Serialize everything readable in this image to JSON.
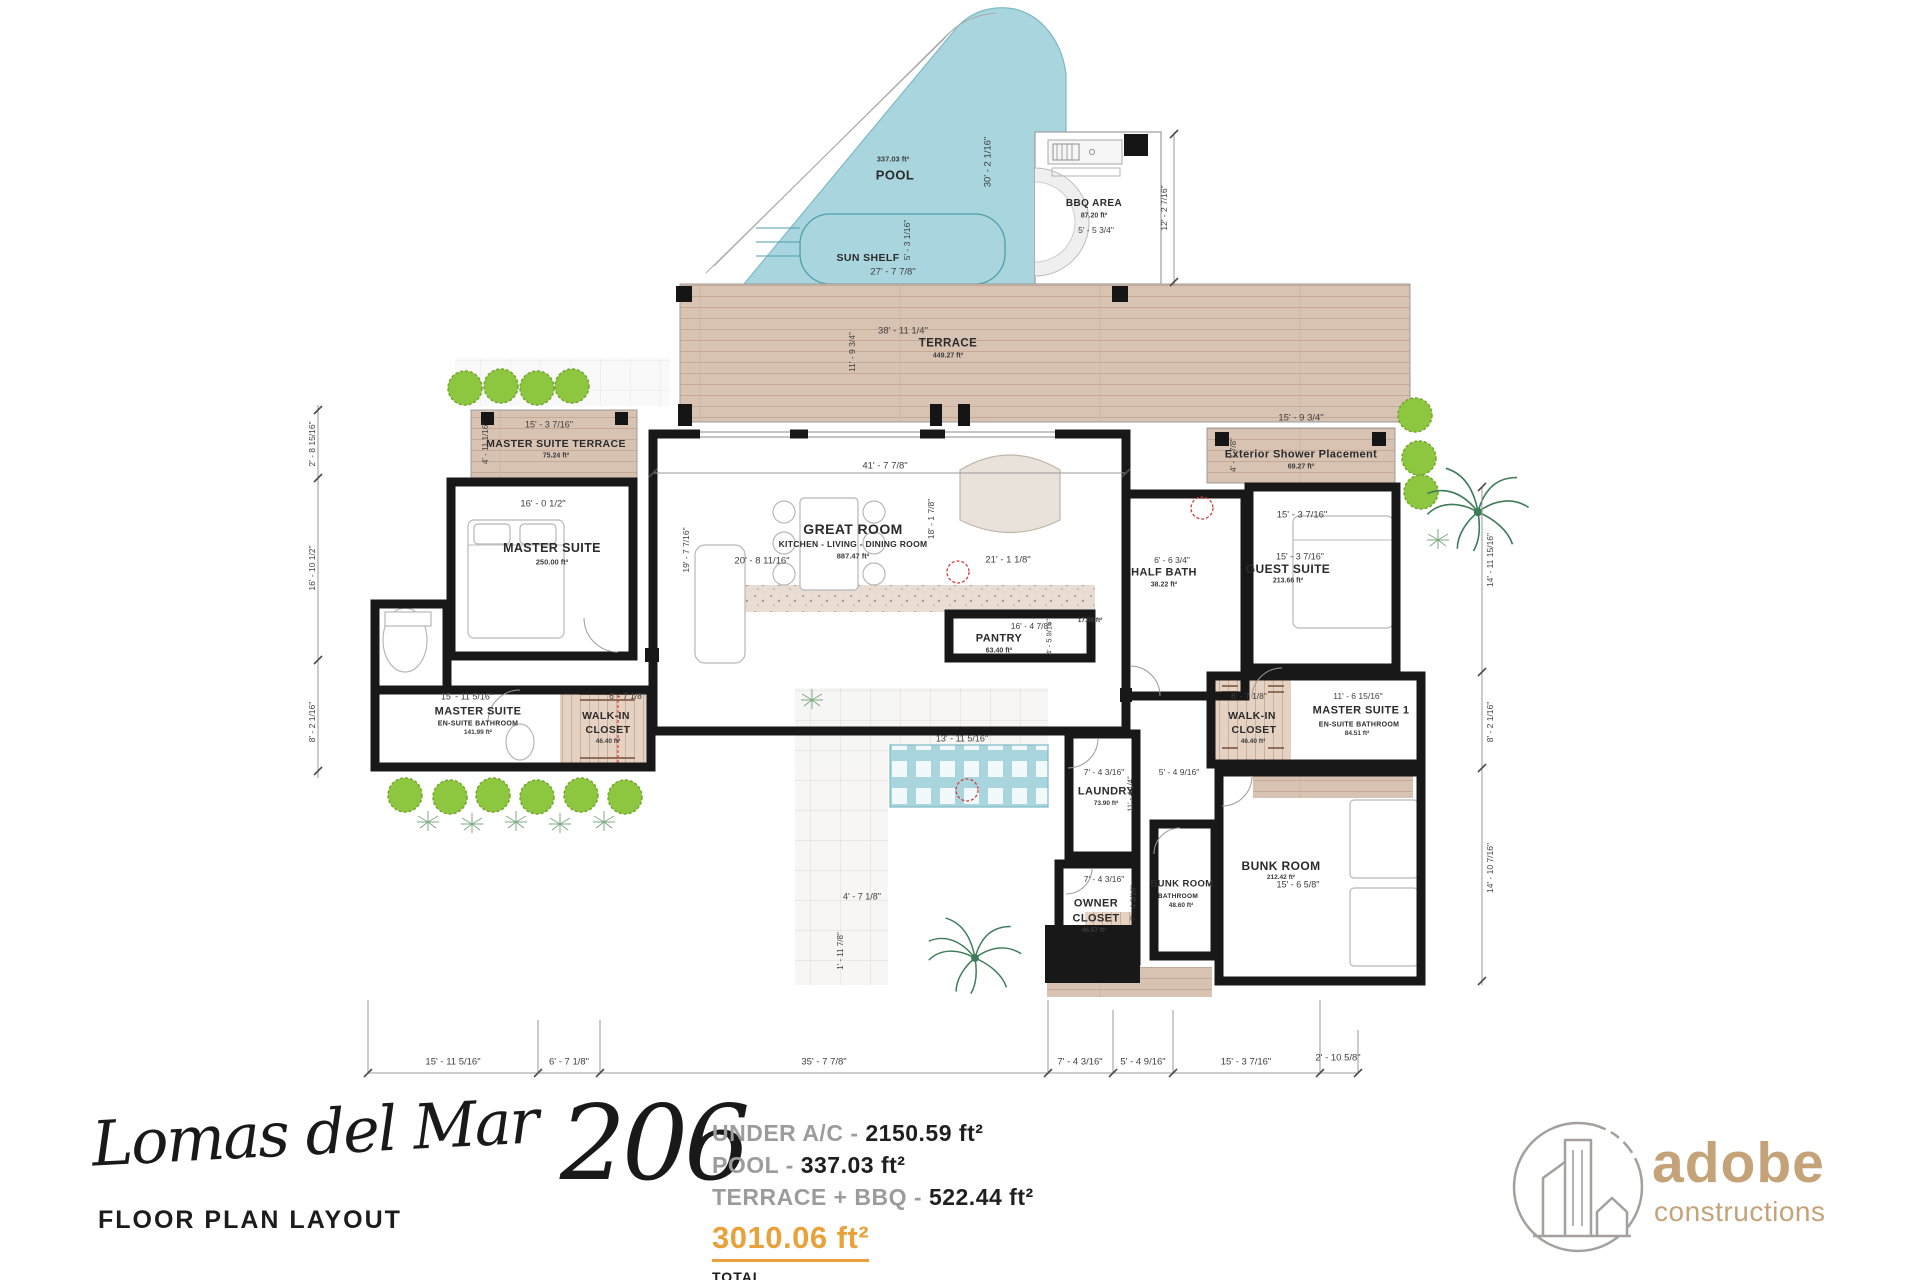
{
  "rooms": {
    "pool": {
      "name": "POOL",
      "area": "337.03 ft²"
    },
    "sun_shelf": {
      "name": "SUN SHELF"
    },
    "bbq": {
      "name": "BBQ AREA",
      "area": "87.20 ft²"
    },
    "terrace": {
      "name": "TERRACE",
      "area": "449.27 ft²"
    },
    "master_suite_terrace": {
      "name": "MASTER SUITE TERRACE",
      "area": "75.24 ft²"
    },
    "master_suite": {
      "name": "MASTER SUITE",
      "area": "250.00 ft²"
    },
    "great_room": {
      "name": "GREAT ROOM",
      "sub": "KITCHEN - LIVING - DINING ROOM",
      "area": "887.47 ft²"
    },
    "pantry": {
      "name": "PANTRY",
      "area": "63.40 ft²"
    },
    "kitchen_counter": {
      "area": "17.08 ft²"
    },
    "half_bath": {
      "name": "HALF BATH",
      "area": "38.22 ft²"
    },
    "guest_suite": {
      "name": "GUEST SUITE",
      "area": "213.66 ft²"
    },
    "exterior_shower": {
      "name": "Exterior Shower Placement",
      "area": "69.27 ft²"
    },
    "master_bath": {
      "name": "MASTER SUITE",
      "sub": "EN-SUITE BATHROOM",
      "area": "141.99 ft²"
    },
    "walk_in_closet_left": {
      "line1": "WALK-IN",
      "line2": "CLOSET",
      "area": "46.40 ft²"
    },
    "laundry": {
      "name": "LAUNDRY",
      "area": "73.90 ft²"
    },
    "owner_closet": {
      "line1": "OWNER",
      "line2": "CLOSET",
      "area": "46.57 ft²"
    },
    "bunk_bath": {
      "name": "BUNK ROOM",
      "sub": "BATHROOM",
      "area": "48.60 ft²"
    },
    "bunk_room": {
      "name": "BUNK ROOM",
      "area": "212.42 ft²"
    },
    "walk_in_closet_right": {
      "line1": "WALK-IN",
      "line2": "CLOSET",
      "area": "46.40 ft²"
    },
    "master_suite1_bath": {
      "name": "MASTER SUITE 1",
      "sub": "EN-SUITE BATHROOM",
      "area": "84.51 ft²"
    }
  },
  "dims": {
    "pool_w": "27' - 7 7/8\"",
    "sun_shelf_h": "5' - 3 1/16\"",
    "pool_h": "30' - 2 1/16\"",
    "bbq_w": "5' - 5 3/4\"",
    "bbq_h": "12' - 2 7/16\"",
    "terrace_w": "38' - 11 1/4\"",
    "terrace_h": "11' - 9 3/4\"",
    "mst_w": "15' - 3 7/16\"",
    "mst_h": "4' - 11 1/16\"",
    "ms_w": "16' - 0 1/2\"",
    "ms_h": "19' - 7 7/16\"",
    "gr_w": "41' - 7 7/8\"",
    "gr_left": "20' - 8 11/16\"",
    "gr_mid": "18' - 1 7/8\"",
    "gr_right": "21' - 1 1/8\"",
    "pantry_w": "16' - 4 7/8\"",
    "pantry_h": "4' - 5 9/16\"",
    "halfbath_w": "6' - 6 3/4\"",
    "guest_top": "15' - 3 7/16\"",
    "guest_mid": "15' - 3 7/16\"",
    "extshower_w": "15' - 9 3/4\"",
    "extshower_h": "4' - 7 7/8\"",
    "msbath_w": "15' - 11 5/16\"",
    "wic_left_w": "6' - 7 1/8\"",
    "laundry_w": "7' - 4 3/16\"",
    "laundry_h": "11' - 4 1/4\"",
    "hall_w": "5' - 4 9/16\"",
    "owner_w": "7' - 4 3/16\"",
    "owner_h": "7' - 4 3/16\"",
    "bunk_w": "15' - 6 5/8\"",
    "wic_right_w": "6' - 7 1/8\"",
    "ms1bath_w": "11' - 6 15/16\"",
    "courtyard_w": "13' - 11 5/16\"",
    "path_w": "4' - 7 1/8\"",
    "path_h": "1' - 11 7/8\"",
    "left_top": "2' - 8 15/16\"",
    "left_mid": "16' - 10 1/2\"",
    "left_bot": "8' - 2 1/16\"",
    "right_top": "14' - 11 15/16\"",
    "right_mid": "8' - 2 1/16\"",
    "right_bot": "14' - 10 7/16\"",
    "bottom": [
      "15' - 11 5/16\"",
      "6' - 7 1/8\"",
      "35' - 7 7/8\"",
      "7' - 4 3/16\"",
      "5' - 4 9/16\"",
      "15' - 3 7/16\"",
      "2' - 10 5/8\""
    ]
  },
  "footer": {
    "title_words": "Lomas del Mar",
    "title_number": "206",
    "subtitle": "FLOOR PLAN LAYOUT",
    "stats": [
      {
        "label": "UNDER A/C - ",
        "value": "2150.59 ft²"
      },
      {
        "label": "POOL - ",
        "value": "337.03 ft²"
      },
      {
        "label": "TERRACE + BBQ - ",
        "value": "522.44 ft²"
      }
    ],
    "total_value": "3010.06 ft²",
    "total_label": "TOTAL",
    "accent_color": "#E9A13B"
  },
  "brand": {
    "name": "adobe",
    "tagline": "constructions",
    "color": "#C4A379"
  },
  "colors": {
    "pool": "#A9D6DE",
    "terrace_wood": "#D8C2B2",
    "wall": "#181818",
    "tree": "#8DC63F",
    "closet_hatch": "#E6D2C3"
  }
}
